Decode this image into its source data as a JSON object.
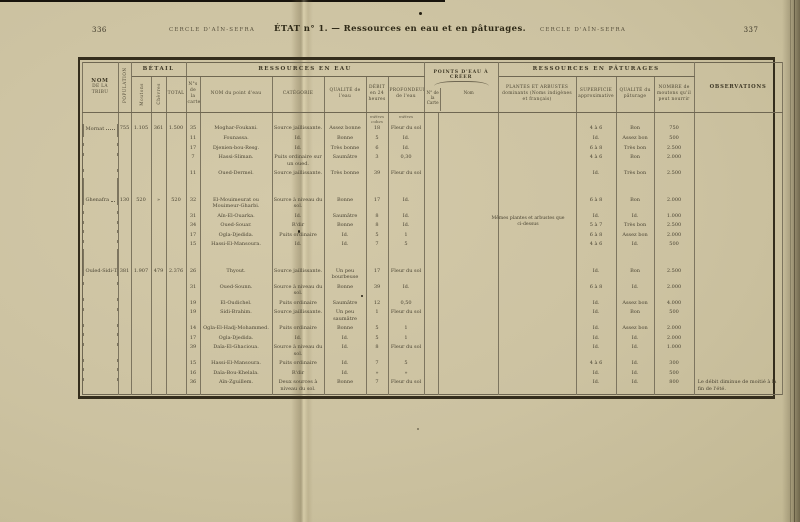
{
  "page": {
    "left_number": "336",
    "left_running_head": "CERCLE D'AÏN-SEFRA",
    "title": "ÉTAT n° 1. — Ressources en eau et en pâturages.",
    "right_running_head": "CERCLE D'AÏN-SEFRA",
    "right_number": "337"
  },
  "colors": {
    "paper": "#ccc2a1",
    "ink": "#474130",
    "rule": "#7d755f",
    "heavy_rule": "#342d1c"
  },
  "table": {
    "headers": {
      "nom_tribu_l1": "NOM",
      "nom_tribu_l2": "DE LA TRIBU",
      "population": "POPULATION",
      "betail_group": "BÉTAIL",
      "moutons": "Moutons",
      "chevres": "Chèvres",
      "total": "TOTAL",
      "eau_group": "RESSOURCES EN EAU",
      "no_carte": "N°s de la carte",
      "nom_point_eau": "NOM du point d'eau",
      "categorie": "CATÉGORIE",
      "qualite_eau": "QUALITÉ de l'eau",
      "debit": "DÉBIT en 24 heures",
      "profondeur": "PROFONDEUR de l'eau",
      "pec_group": "POINTS D'EAU À CRÉER",
      "pec_no": "N° de la Carte",
      "pec_nom": "Nom",
      "paturages_group": "RESSOURCES EN PÂTURAGES",
      "plantes": "PLANTES ET ARBUSTES dominants (Noms indigènes et français)",
      "superficie": "SUPERFICIE approximative",
      "qualite_paturage": "QUALITÉ du pâturage",
      "nombre": "NOMBRE de moutons qu'il peut nourrir",
      "observations": "OBSERVATIONS"
    },
    "units": {
      "debit": "mètres cubes",
      "profondeur": "mètres"
    },
    "plantes_note": "Mêmes plantes et arbustes que ci-dessus",
    "groups": [
      {
        "tribu": "Mornat",
        "population": "755",
        "moutons": "1.105",
        "chevres": "361",
        "total": "1.500",
        "rows": [
          {
            "no": "35",
            "nom": "Moghar-Foukani.",
            "categorie": "Source jaillissante.",
            "qualite": "Assez bonne",
            "debit": "18",
            "profondeur": "Fleur du sol",
            "superficie": "4 à 6",
            "qualite_pat": "Bon",
            "nombre": "750"
          },
          {
            "no": "11",
            "nom": "Founassa.",
            "categorie": "Id.",
            "qualite": "Bonne",
            "debit": "5",
            "profondeur": "Id.",
            "superficie": "Id.",
            "qualite_pat": "Assez bon",
            "nombre": "500"
          },
          {
            "no": "17",
            "nom": "Djenien-bou-Resg.",
            "categorie": "Id.",
            "qualite": "Très bonne",
            "debit": "6",
            "profondeur": "Id.",
            "superficie": "6 à 8",
            "qualite_pat": "Très bon",
            "nombre": "2.500"
          },
          {
            "no": "7",
            "nom": "Hassi-Sliman.",
            "categorie": "Puits ordinaire sur un oued.",
            "qualite": "Saumâtre",
            "debit": "3",
            "profondeur": "0,30",
            "superficie": "4 à 6",
            "qualite_pat": "Bon",
            "nombre": "2.000"
          },
          {
            "no": "11",
            "nom": "Oued-Dermel.",
            "categorie": "Source jaillissante.",
            "qualite": "Très bonne",
            "debit": "39",
            "profondeur": "Fleur du sol",
            "superficie": "Id.",
            "qualite_pat": "Très bon",
            "nombre": "2.500"
          }
        ]
      },
      {
        "tribu": "Ghenafra",
        "population": "130",
        "moutons": "520",
        "chevres": "»",
        "total": "520",
        "rows": [
          {
            "no": "32",
            "nom": "El-Mouimeurat ou Mouimeur-Gharbi.",
            "categorie": "Source à niveau du sol.",
            "qualite": "Bonne",
            "debit": "17",
            "profondeur": "Id.",
            "superficie": "6 à 8",
            "qualite_pat": "Bon",
            "nombre": "2.000"
          },
          {
            "no": "31",
            "nom": "Aïn-El-Ouarka.",
            "categorie": "Id.",
            "qualite": "Saumâtre",
            "debit": "8",
            "profondeur": "Id.",
            "superficie": "Id.",
            "qualite_pat": "Id.",
            "nombre": "1.000"
          },
          {
            "no": "34",
            "nom": "Oued-Souar.",
            "categorie": "R'dir",
            "qualite": "Bonne",
            "debit": "8",
            "profondeur": "Id.",
            "superficie": "5 à 7",
            "qualite_pat": "Très bon",
            "nombre": "2.500"
          },
          {
            "no": "17",
            "nom": "Ogla-Djedida.",
            "categorie": "Puits ordinaire",
            "qualite": "Id.",
            "debit": "5",
            "profondeur": "1",
            "superficie": "6 à 8",
            "qualite_pat": "Assez bon",
            "nombre": "2.000"
          },
          {
            "no": "15",
            "nom": "Hassi-El-Mansoura.",
            "categorie": "Id.",
            "qualite": "Id.",
            "debit": "7",
            "profondeur": "5",
            "superficie": "4 à 6",
            "qualite_pat": "Id.",
            "nombre": "500"
          }
        ]
      },
      {
        "tribu": "Ouled-Sidi-Tadj",
        "population": "381",
        "moutons": "1.907",
        "chevres": "479",
        "total": "2.376",
        "rows": [
          {
            "no": "26",
            "nom": "Thyout.",
            "categorie": "Source jaillissante.",
            "qualite": "Un peu bourbeuse",
            "debit": "17",
            "profondeur": "Fleur du sol",
            "superficie": "Id.",
            "qualite_pat": "Bon",
            "nombre": "2.500"
          },
          {
            "no": "31",
            "nom": "Oued-Sounn.",
            "categorie": "Source à niveau du sol.",
            "qualite": "Bonne",
            "debit": "39",
            "profondeur": "Id.",
            "superficie": "6 à 8",
            "qualite_pat": "Id.",
            "nombre": "2.000"
          },
          {
            "no": "19",
            "nom": "El-Oudichel.",
            "categorie": "Puits ordinaire",
            "qualite": "Saumâtre",
            "debit": "12",
            "profondeur": "0,50",
            "superficie": "Id.",
            "qualite_pat": "Assez bon",
            "nombre": "4.000"
          },
          {
            "no": "19",
            "nom": "Sidi-Brahim.",
            "categorie": "Source jaillissante.",
            "qualite": "Un peu saumâtre",
            "debit": "1",
            "profondeur": "Fleur du sol",
            "superficie": "Id.",
            "qualite_pat": "Bon",
            "nombre": "500"
          },
          {
            "no": "14",
            "nom": "Ogla-El-Hadj-Mohammed.",
            "categorie": "Puits ordinaire",
            "qualite": "Bonne",
            "debit": "5",
            "profondeur": "1",
            "superficie": "Id.",
            "qualite_pat": "Assez bon",
            "nombre": "2.000"
          },
          {
            "no": "17",
            "nom": "Ogla-Djedida.",
            "categorie": "Id.",
            "qualite": "Id.",
            "debit": "5",
            "profondeur": "1",
            "superficie": "Id.",
            "qualite_pat": "Id.",
            "nombre": "2.000"
          },
          {
            "no": "39",
            "nom": "Daïa-El-Ghacioua.",
            "categorie": "Source à niveau du sol.",
            "qualite": "Id.",
            "debit": "8",
            "profondeur": "Fleur du sol",
            "superficie": "Id.",
            "qualite_pat": "Id.",
            "nombre": "1.000"
          },
          {
            "no": "15",
            "nom": "Hassi-El-Mansoura.",
            "categorie": "Puits ordinaire",
            "qualite": "Id.",
            "debit": "7",
            "profondeur": "5",
            "superficie": "4 à 6",
            "qualite_pat": "Id.",
            "nombre": "300"
          },
          {
            "no": "16",
            "nom": "Daïa-Bou-Khelala.",
            "categorie": "R'dir",
            "qualite": "Id.",
            "debit": "»",
            "profondeur": "»",
            "superficie": "Id.",
            "qualite_pat": "Id.",
            "nombre": "500"
          },
          {
            "no": "36",
            "nom": "Aïn-Zguillem.",
            "categorie": "Deux sources à niveau du sol.",
            "qualite": "Bonne",
            "debit": "7",
            "profondeur": "Fleur du sol",
            "superficie": "Id.",
            "qualite_pat": "Id.",
            "nombre": "800",
            "observation": "Le débit diminue de moitié à la fin de l'été."
          }
        ]
      }
    ]
  }
}
